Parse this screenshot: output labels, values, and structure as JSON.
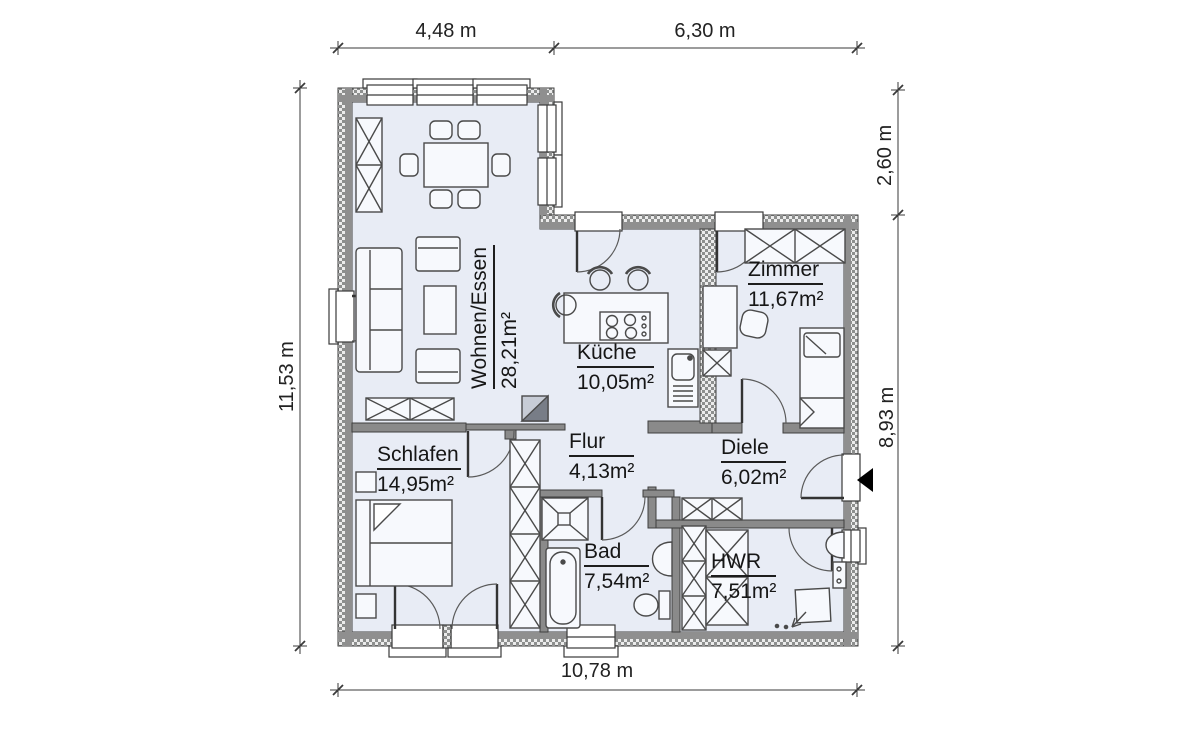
{
  "plan": {
    "rooms": [
      {
        "id": "wohnen",
        "name": "Wohnen/Essen",
        "area": "28,21m²"
      },
      {
        "id": "kueche",
        "name": "Küche",
        "area": "10,05m²"
      },
      {
        "id": "zimmer",
        "name": "Zimmer",
        "area": "11,67m²"
      },
      {
        "id": "schlafen",
        "name": "Schlafen",
        "area": "14,95m²"
      },
      {
        "id": "flur",
        "name": "Flur",
        "area": "4,13m²"
      },
      {
        "id": "diele",
        "name": "Diele",
        "area": "6,02m²"
      },
      {
        "id": "bad",
        "name": "Bad",
        "area": "7,54m²"
      },
      {
        "id": "hwr",
        "name": "HWR",
        "area": "7,51m²"
      }
    ],
    "dimensions": {
      "top_left": "4,48 m",
      "top_right": "6,30 m",
      "left": "11,53 m",
      "right_upper": "2,60 m",
      "right_lower": "8,93 m",
      "bottom": "10,78 m"
    },
    "colors": {
      "floor": "#e8ecf5",
      "wall": "#8f8f8f",
      "line": "#3a3a3a"
    }
  }
}
